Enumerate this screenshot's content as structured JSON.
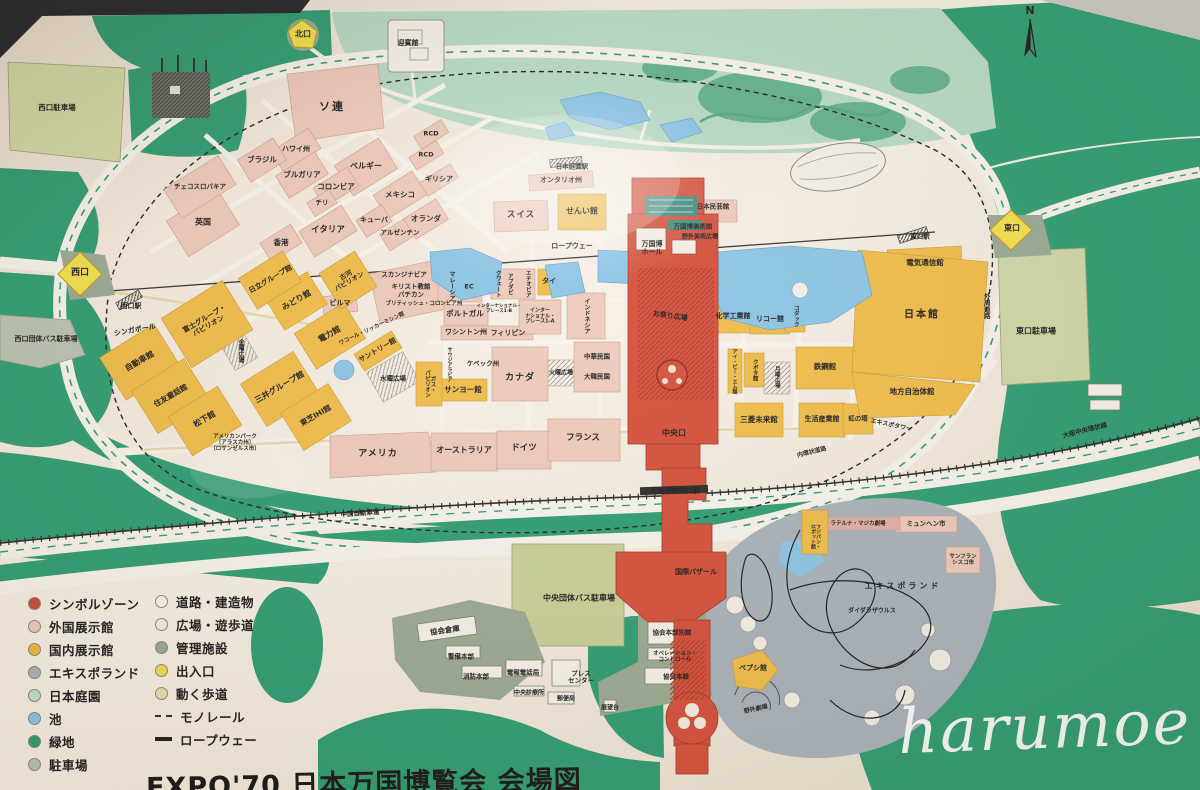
{
  "title": "EXPO'70 日本万国博覧会 会場図",
  "watermark": "harumoe",
  "compass": {
    "label": "N"
  },
  "legend": {
    "left": [
      {
        "label": "シンボルゾーン",
        "color": "#c84a38",
        "type": "dot"
      },
      {
        "label": "外国展示館",
        "color": "#eec9b8",
        "type": "dot"
      },
      {
        "label": "国内展示館",
        "color": "#eeb83e",
        "type": "dot"
      },
      {
        "label": "エキスポランド",
        "color": "#a9b4bd",
        "type": "dot"
      },
      {
        "label": "日本庭園",
        "color": "#c3e0ce",
        "type": "dot"
      },
      {
        "label": "池",
        "color": "#8cc5e7",
        "type": "dot"
      },
      {
        "label": "緑地",
        "color": "#2e9d73",
        "type": "dot"
      },
      {
        "label": "駐車場",
        "color": "#b9c3b2",
        "type": "dot"
      }
    ],
    "right": [
      {
        "label": "道路・建造物",
        "color": "#f8f4ec",
        "type": "dot"
      },
      {
        "label": "広場・遊歩道",
        "color": "#f3eee2",
        "type": "dot"
      },
      {
        "label": "管理施設",
        "color": "#97a88f",
        "type": "dot"
      },
      {
        "label": "出入口",
        "color": "#f0dd4e",
        "type": "dot"
      },
      {
        "label": "動く歩道",
        "color": "#e9dfae",
        "type": "dot"
      },
      {
        "label": "モノレール",
        "type": "dashed-line"
      },
      {
        "label": "ロープウェー",
        "type": "solid-line"
      }
    ]
  },
  "map": {
    "labels": [
      {
        "t": "西口",
        "x": 80,
        "y": 273,
        "s": 9
      },
      {
        "t": "北口",
        "x": 303,
        "y": 35,
        "s": 8
      },
      {
        "t": "東口",
        "x": 1012,
        "y": 229,
        "s": 8
      },
      {
        "t": "中央口",
        "x": 674,
        "y": 434,
        "s": 8
      },
      {
        "t": "西口駅",
        "x": 131,
        "y": 307,
        "s": 7
      },
      {
        "t": "日本庭園駅",
        "x": 572,
        "y": 167,
        "s": 6.5
      },
      {
        "t": "東口駅",
        "x": 920,
        "y": 237,
        "s": 6.5
      },
      {
        "t": "万国博中央口駅",
        "x": 675,
        "y": 492,
        "s": 7
      },
      {
        "t": "ロープウェー",
        "x": 572,
        "y": 247,
        "s": 7
      },
      {
        "t": "中国自動車道",
        "x": 360,
        "y": 514,
        "s": 6.5,
        "r": -4
      },
      {
        "t": "大阪中央環状線",
        "x": 1085,
        "y": 431,
        "s": 6.5,
        "r": -14
      },
      {
        "t": "外周道路",
        "x": 986,
        "y": 306,
        "s": 6.5,
        "v": true,
        "h": 44
      },
      {
        "t": "内環状道路",
        "x": 812,
        "y": 453,
        "s": 6,
        "r": -14
      },
      {
        "t": "ソ連",
        "x": 332,
        "y": 107,
        "s": 11,
        "ls": 2
      },
      {
        "t": "迎賓館",
        "x": 408,
        "y": 44,
        "s": 7
      },
      {
        "t": "西口駐車場",
        "x": 57,
        "y": 108,
        "s": 7.5
      },
      {
        "t": "チェコスロバキア",
        "x": 200,
        "y": 187,
        "s": 6.5
      },
      {
        "t": "英国",
        "x": 203,
        "y": 223,
        "s": 8
      },
      {
        "t": "ハワイ州",
        "x": 296,
        "y": 150,
        "s": 7
      },
      {
        "t": "ブラジル",
        "x": 262,
        "y": 160,
        "s": 7.5
      },
      {
        "t": "ブルガリア",
        "x": 302,
        "y": 175,
        "s": 7.5
      },
      {
        "t": "ベルギー",
        "x": 366,
        "y": 167,
        "s": 8
      },
      {
        "t": "コロンビア",
        "x": 336,
        "y": 187,
        "s": 7.5
      },
      {
        "t": "メキシコ",
        "x": 400,
        "y": 195,
        "s": 7.5
      },
      {
        "t": "チリ",
        "x": 322,
        "y": 203,
        "s": 6.5
      },
      {
        "t": "キューバ",
        "x": 374,
        "y": 221,
        "s": 7
      },
      {
        "t": "イタリア",
        "x": 328,
        "y": 231,
        "s": 8.5
      },
      {
        "t": "アルゼンチン",
        "x": 400,
        "y": 233,
        "s": 6.5
      },
      {
        "t": "オランダ",
        "x": 426,
        "y": 219,
        "s": 7.5
      },
      {
        "t": "香港",
        "x": 281,
        "y": 243,
        "s": 7.5
      },
      {
        "t": "RCD",
        "x": 431,
        "y": 134,
        "s": 6.5
      },
      {
        "t": "RCD",
        "x": 426,
        "y": 155,
        "s": 6.5
      },
      {
        "t": "ギリシア",
        "x": 439,
        "y": 180,
        "s": 7
      },
      {
        "t": "オンタリオ州",
        "x": 561,
        "y": 181,
        "s": 7
      },
      {
        "t": "スイス",
        "x": 521,
        "y": 216,
        "s": 8.5,
        "ls": 1
      },
      {
        "t": "せんい館",
        "x": 582,
        "y": 212,
        "s": 8
      },
      {
        "t": "日立グループ館",
        "x": 271,
        "y": 280,
        "s": 7,
        "r": -30
      },
      {
        "t": "みどり館",
        "x": 297,
        "y": 301,
        "s": 8,
        "r": -30
      },
      {
        "t": "古河\nパビリオン",
        "x": 348,
        "y": 279,
        "s": 6.5,
        "r": -30
      },
      {
        "t": "電力館",
        "x": 330,
        "y": 335,
        "s": 8,
        "r": -30
      },
      {
        "t": "富士グループ・\nパビリオン",
        "x": 207,
        "y": 323,
        "s": 7,
        "r": -30
      },
      {
        "t": "自動車館",
        "x": 140,
        "y": 362,
        "s": 8,
        "r": -30
      },
      {
        "t": "住友童話館",
        "x": 171,
        "y": 396,
        "s": 7.5,
        "r": -30
      },
      {
        "t": "松下館",
        "x": 205,
        "y": 420,
        "s": 8,
        "r": -30
      },
      {
        "t": "三井グループ館",
        "x": 280,
        "y": 388,
        "s": 8,
        "r": -30
      },
      {
        "t": "東芝IHI館",
        "x": 316,
        "y": 416,
        "s": 7.5,
        "r": -30
      },
      {
        "t": "サントリー館",
        "x": 378,
        "y": 351,
        "s": 7,
        "r": -30
      },
      {
        "t": "ワコール・リッカーミシン館",
        "x": 372,
        "y": 329,
        "s": 5.5,
        "r": -25
      },
      {
        "t": "金曜広場",
        "x": 240,
        "y": 351,
        "s": 6,
        "v": true,
        "h": 26
      },
      {
        "t": "水曜広場",
        "x": 393,
        "y": 379,
        "s": 6.5
      },
      {
        "t": "アメリカンパーク\n〔アラスカ州〕\n〔ロサンゼルス市〕",
        "x": 235,
        "y": 443,
        "s": 5.5
      },
      {
        "t": "シンガポール",
        "x": 135,
        "y": 331,
        "s": 7,
        "r": -10
      },
      {
        "t": "西口団体バス駐車場",
        "x": 46,
        "y": 340,
        "s": 7
      },
      {
        "t": "スカンジナビア",
        "x": 404,
        "y": 275,
        "s": 6.5
      },
      {
        "t": "キリスト教館",
        "x": 411,
        "y": 287,
        "s": 6.5
      },
      {
        "t": "バチカン",
        "x": 411,
        "y": 295,
        "s": 6.5
      },
      {
        "t": "ブリティッシュ・コロンビア州",
        "x": 424,
        "y": 304,
        "s": 5.5
      },
      {
        "t": "ビルマ",
        "x": 340,
        "y": 304,
        "s": 7
      },
      {
        "t": "マレーシア",
        "x": 451,
        "y": 286,
        "s": 6,
        "v": true,
        "h": 36
      },
      {
        "t": "EC",
        "x": 469,
        "y": 287,
        "s": 6.5
      },
      {
        "t": "クウェート",
        "x": 497,
        "y": 284,
        "s": 5.5,
        "v": true,
        "h": 30
      },
      {
        "t": "アブダビ",
        "x": 509,
        "y": 284,
        "s": 5.5,
        "v": true,
        "h": 26
      },
      {
        "t": "エチオピア",
        "x": 527,
        "y": 284,
        "s": 5.5,
        "v": true,
        "h": 30
      },
      {
        "t": "タイ",
        "x": 549,
        "y": 282,
        "s": 7
      },
      {
        "t": "ポルトガル",
        "x": 465,
        "y": 314,
        "s": 7.5
      },
      {
        "t": "ワシントン州",
        "x": 466,
        "y": 333,
        "s": 7
      },
      {
        "t": "フィリピン",
        "x": 508,
        "y": 334,
        "s": 7
      },
      {
        "t": "インターナショナル・\nプレース1-B",
        "x": 499,
        "y": 309,
        "s": 4.5
      },
      {
        "t": "インター\nナショナル・\nプレース1-A",
        "x": 540,
        "y": 317,
        "s": 5
      },
      {
        "t": "インドネシア",
        "x": 586,
        "y": 316,
        "s": 6,
        "v": true,
        "h": 40
      },
      {
        "t": "中華民国",
        "x": 597,
        "y": 357,
        "s": 6.5
      },
      {
        "t": "大韓民国",
        "x": 597,
        "y": 377,
        "s": 6.5
      },
      {
        "t": "カナダ",
        "x": 520,
        "y": 378,
        "s": 9,
        "ls": 1
      },
      {
        "t": "ケベック州",
        "x": 483,
        "y": 364,
        "s": 6.5
      },
      {
        "t": "サウジアラビア",
        "x": 449,
        "y": 364,
        "s": 5,
        "v": true,
        "h": 34
      },
      {
        "t": "ガス・\nパビリオン",
        "x": 429,
        "y": 384,
        "s": 5.5,
        "v": true,
        "h": 38
      },
      {
        "t": "サンヨー館",
        "x": 463,
        "y": 390,
        "s": 7.5
      },
      {
        "t": "火曜広場",
        "x": 561,
        "y": 374,
        "s": 6
      },
      {
        "t": "アメリカ",
        "x": 378,
        "y": 454,
        "s": 9,
        "ls": 1
      },
      {
        "t": "オーストラリア",
        "x": 464,
        "y": 451,
        "s": 8
      },
      {
        "t": "ドイツ",
        "x": 524,
        "y": 449,
        "s": 8.5
      },
      {
        "t": "フランス",
        "x": 583,
        "y": 439,
        "s": 8.5
      },
      {
        "t": "日本民芸館",
        "x": 713,
        "y": 207,
        "s": 6.5
      },
      {
        "t": "万国博美術館",
        "x": 693,
        "y": 227,
        "s": 6.5
      },
      {
        "t": "野外美術広場",
        "x": 700,
        "y": 238,
        "s": 6
      },
      {
        "t": "万国博\nホール",
        "x": 652,
        "y": 249,
        "s": 7
      },
      {
        "t": "お祭り広場",
        "x": 670,
        "y": 317,
        "s": 7,
        "r": 8
      },
      {
        "t": "化学工業館",
        "x": 733,
        "y": 317,
        "s": 7
      },
      {
        "t": "リコー館",
        "x": 770,
        "y": 320,
        "s": 7
      },
      {
        "t": "コダック",
        "x": 795,
        "y": 316,
        "s": 5.5,
        "v": true,
        "h": 30
      },
      {
        "t": "アイ・ビー・エム館",
        "x": 734,
        "y": 371,
        "s": 5,
        "v": true,
        "h": 52
      },
      {
        "t": "クボタ館",
        "x": 754,
        "y": 370,
        "s": 5.5,
        "v": true,
        "h": 30
      },
      {
        "t": "月曜広場",
        "x": 776,
        "y": 377,
        "s": 5.5,
        "v": true,
        "h": 30
      },
      {
        "t": "鉄鋼館",
        "x": 825,
        "y": 367,
        "s": 7.5
      },
      {
        "t": "三菱未来館",
        "x": 759,
        "y": 420,
        "s": 7.5
      },
      {
        "t": "生活産業館",
        "x": 822,
        "y": 420,
        "s": 7
      },
      {
        "t": "虹の塔",
        "x": 858,
        "y": 419,
        "s": 6.5
      },
      {
        "t": "エキスポタワー",
        "x": 891,
        "y": 426,
        "s": 6,
        "r": 12
      },
      {
        "t": "電気通信館",
        "x": 925,
        "y": 263,
        "s": 7.5
      },
      {
        "t": "日本館",
        "x": 922,
        "y": 315,
        "s": 10,
        "ls": 2
      },
      {
        "t": "地方自治体館",
        "x": 912,
        "y": 392,
        "s": 7.5
      },
      {
        "t": "東口駐車場",
        "x": 1036,
        "y": 332,
        "s": 8
      },
      {
        "t": "国際バザール",
        "x": 696,
        "y": 573,
        "s": 7
      },
      {
        "t": "中央団体バス駐車場",
        "x": 579,
        "y": 599,
        "s": 8
      },
      {
        "t": "協会倉庫",
        "x": 445,
        "y": 631,
        "s": 7.5,
        "r": -8
      },
      {
        "t": "警備本部",
        "x": 461,
        "y": 657,
        "s": 6.5
      },
      {
        "t": "消防本部",
        "x": 476,
        "y": 677,
        "s": 6.5
      },
      {
        "t": "電報電話局",
        "x": 523,
        "y": 673,
        "s": 6.5
      },
      {
        "t": "プレス\nセンター",
        "x": 581,
        "y": 678,
        "s": 6.5
      },
      {
        "t": "中央診療所",
        "x": 529,
        "y": 694,
        "s": 6
      },
      {
        "t": "郵便局",
        "x": 566,
        "y": 700,
        "s": 6
      },
      {
        "t": "協会本部別館",
        "x": 672,
        "y": 633,
        "s": 6.5
      },
      {
        "t": "オペレーション・\nコントロール",
        "x": 675,
        "y": 657,
        "s": 5.5
      },
      {
        "t": "協会本館",
        "x": 676,
        "y": 677,
        "s": 6.5
      },
      {
        "t": "展望台",
        "x": 610,
        "y": 709,
        "s": 6
      },
      {
        "t": "ペプシ館",
        "x": 753,
        "y": 669,
        "s": 7
      },
      {
        "t": "野外劇場",
        "x": 756,
        "y": 710,
        "s": 6,
        "r": -12
      },
      {
        "t": "フジパン・\nロボット館",
        "x": 815,
        "y": 536,
        "s": 5,
        "v": true,
        "h": 50
      },
      {
        "t": "ラテルナ・マジカ劇場",
        "x": 858,
        "y": 524,
        "s": 5.5
      },
      {
        "t": "ミュンヘン市",
        "x": 926,
        "y": 524,
        "s": 6.5
      },
      {
        "t": "サンフラン\nシスコ市",
        "x": 963,
        "y": 560,
        "s": 5.5
      },
      {
        "t": "エキスポランド",
        "x": 903,
        "y": 587,
        "s": 8,
        "ls": 3
      },
      {
        "t": "ダイダラザウルス",
        "x": 872,
        "y": 612,
        "s": 6
      }
    ]
  }
}
